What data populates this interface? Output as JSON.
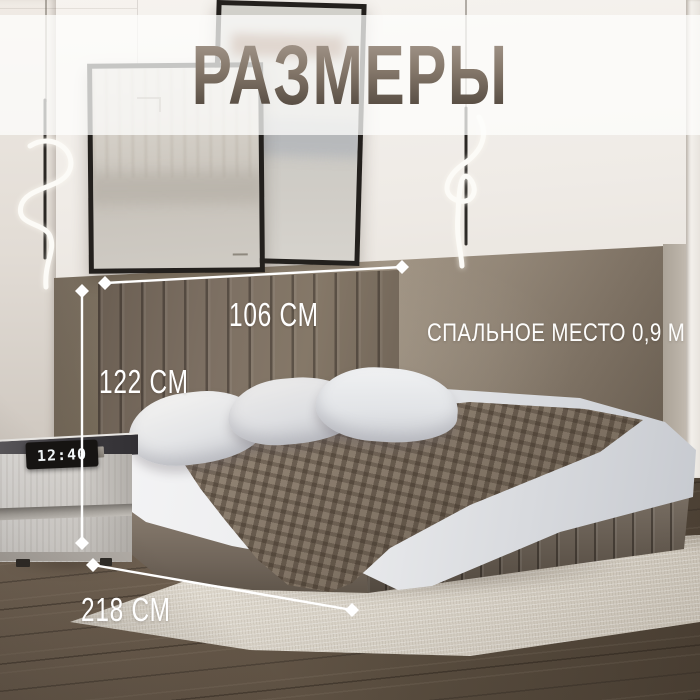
{
  "meta": {
    "language": "ru",
    "description": "product dimensions infographic of an upholstered bed in a bedroom"
  },
  "banner": {
    "title": "РАЗМЕРЫ"
  },
  "annotations": {
    "headboard_width": {
      "label": "106 СМ"
    },
    "bed_height": {
      "label": "122 СМ"
    },
    "bed_length": {
      "label": "218 СМ"
    },
    "sleeping_area": {
      "label": "СПАЛЬНОЕ МЕСТО 0,9 М"
    }
  },
  "nightstand": {
    "clock_time": "12:40"
  },
  "colors": {
    "annotation_white": "#ffffff",
    "title_gradient_top": "#a3968a",
    "title_gradient_bottom": "#4f453c",
    "banner_tint": "rgba(253,253,252,0.75)",
    "accent_wall_taupe": "#8d8070",
    "bed_upholstery": "#76695d",
    "blanket": "#8a7c6c",
    "floor_wood": "#5a4e40",
    "rug": "#d9d3c8",
    "clock_digits": "#f2f7f9"
  }
}
